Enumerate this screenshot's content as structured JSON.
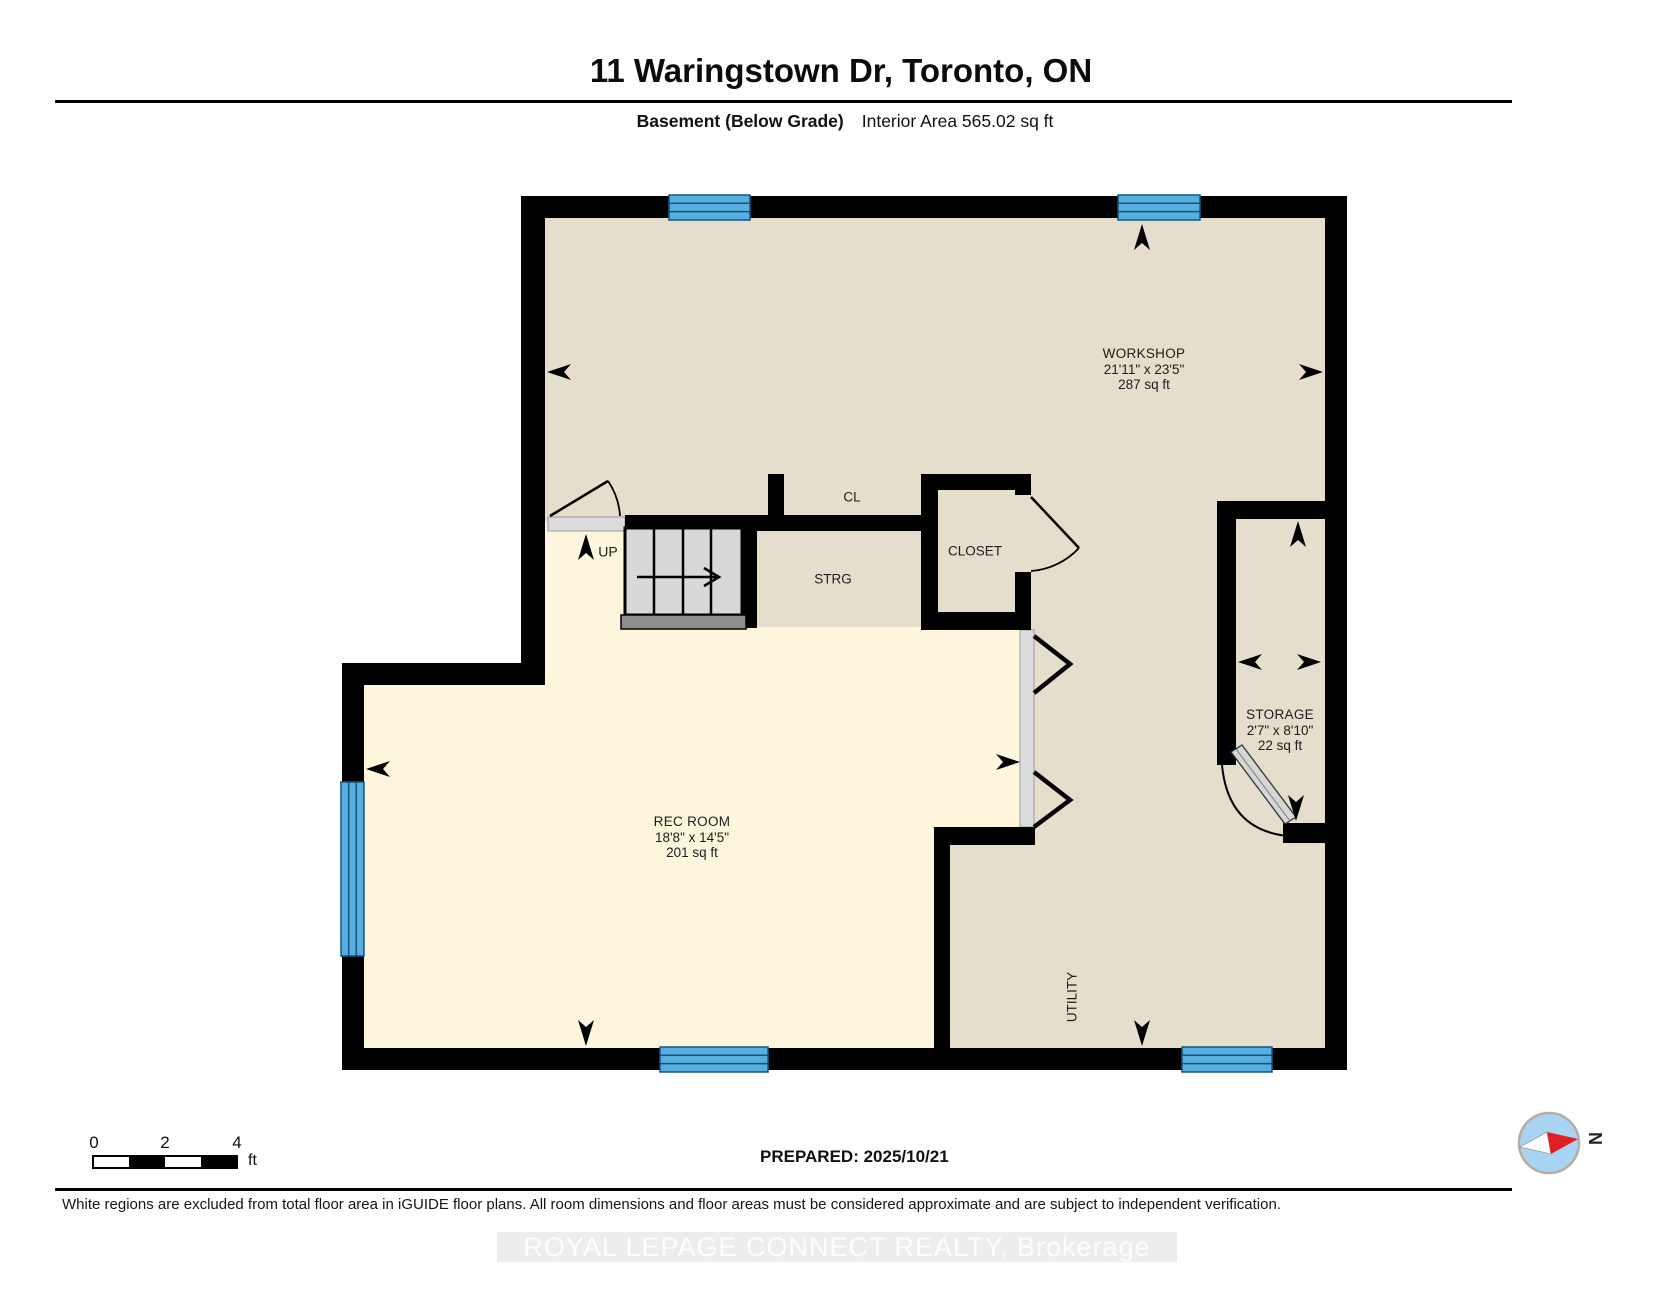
{
  "header": {
    "title": "11 Waringstown Dr, Toronto, ON",
    "floor_label": "Basement (Below Grade)",
    "area_label": "Interior Area 565.02 sq ft"
  },
  "rooms": {
    "workshop": {
      "name": "WORKSHOP",
      "dims": "21'11\" x 23'5\"",
      "area": "287 sq ft"
    },
    "rec_room": {
      "name": "REC ROOM",
      "dims": "18'8\" x 14'5\"",
      "area": "201 sq ft"
    },
    "storage": {
      "name": "STORAGE",
      "dims": "2'7\" x 8'10\"",
      "area": "22 sq ft"
    },
    "closet": {
      "name": "CLOSET"
    },
    "cl": {
      "name": "CL"
    },
    "strg": {
      "name": "STRG"
    },
    "utility": {
      "name": "UTILITY"
    },
    "stairs": {
      "label": "UP"
    }
  },
  "scale_bar": {
    "tick_0": "0",
    "tick_2": "2",
    "tick_4": "4",
    "unit": "ft"
  },
  "prepared_label": "PREPARED: 2025/10/21",
  "compass": {
    "label": "N"
  },
  "footer": {
    "disclaimer": "White regions are excluded from total floor area in iGUIDE floor plans. All room dimensions and floor areas must be considered approximate and are subject to independent verification.",
    "watermark": "ROYAL LEPAGE CONNECT REALTY, Brokerage"
  },
  "colors": {
    "wall": "#000000",
    "floor_included": "#fdf6dc",
    "floor_excluded_shade": "#e5decc",
    "window_blue": "#58aede",
    "window_line": "#14557f",
    "stair_fill": "#d8d8d8",
    "stair_nosing": "#8e8e8e",
    "threshold_gray": "#dcdcdc",
    "compass_fill": "#a9d3f2",
    "compass_needle_red": "#e02020",
    "watermark_band": "#ededed"
  }
}
